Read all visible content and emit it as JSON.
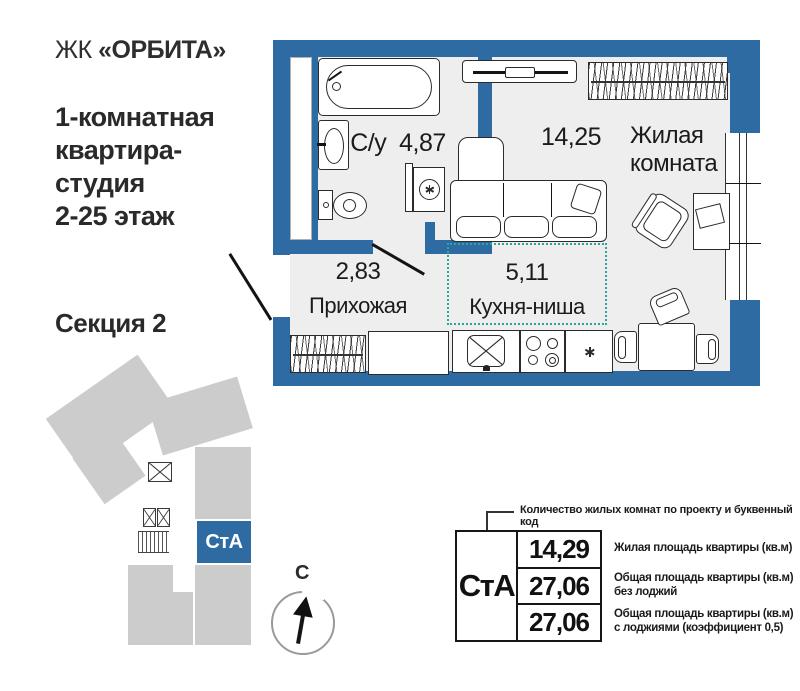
{
  "header": {
    "complex_prefix": "ЖК",
    "complex_name": "«ОРБИТА»",
    "title_lines": [
      "1-комнатная",
      "квартира-",
      "студия",
      "2-25 этаж"
    ],
    "section_label": "Секция 2"
  },
  "plan": {
    "rooms": {
      "bathroom": {
        "name": "С/у",
        "area": "4,87"
      },
      "living": {
        "name_line1": "Жилая",
        "name_line2": "комната",
        "area": "14,25"
      },
      "hallway": {
        "name": "Прихожая",
        "area": "2,83"
      },
      "kitchen": {
        "name": "Кухня-ниша",
        "area": "5,11"
      }
    }
  },
  "section_diagram": {
    "unit_code": "СтА"
  },
  "compass": {
    "north_label": "С"
  },
  "spec_table": {
    "callout": "Количество жилых комнат по проекту и буквенный код",
    "unit_code": "СтА",
    "rows": [
      {
        "value": "14,29",
        "desc_line1": "Жилая площадь квартиры (кв.м)",
        "desc_line2": ""
      },
      {
        "value": "27,06",
        "desc_line1": "Общая площадь квартиры (кв.м)",
        "desc_line2": "без лоджий"
      },
      {
        "value": "27,06",
        "desc_line1": "Общая площадь квартиры (кв.м)",
        "desc_line2": "с лоджиями (коэффициент 0,5)"
      }
    ]
  },
  "colors": {
    "wall_blue": "#2e6ba3",
    "floor_gray": "#efeeee",
    "kitchen_teal": "#2ba69b",
    "block_gray": "#cccccc"
  }
}
